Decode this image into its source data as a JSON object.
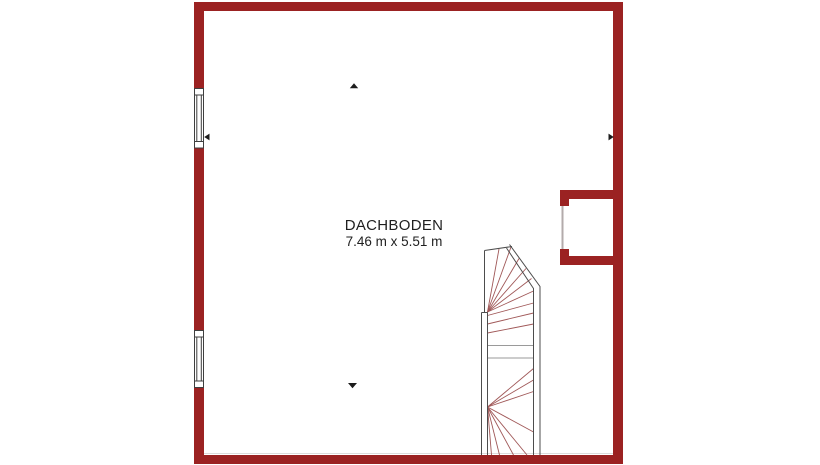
{
  "plan": {
    "room_label": "DACHBODEN",
    "room_dimensions": "7.46 m x 5.51 m"
  },
  "colors": {
    "background": "#FFFFFF",
    "wall": "#9B2222",
    "window_frame": "#3F3F3F",
    "stair_outline": "#4D4D4D",
    "stair_tread": "#A05858",
    "stair_tread_gray": "#9A9A9A",
    "marker": "#1C1C1C",
    "niche_opening": "#B3ABAB",
    "hairline": "#DCDCDC",
    "text": "#1F1F1F"
  },
  "icons": {
    "slope_marker_up": "triangle-up",
    "slope_marker_down": "triangle-down",
    "slope_marker_left": "triangle-left",
    "slope_marker_right": "triangle-right"
  }
}
